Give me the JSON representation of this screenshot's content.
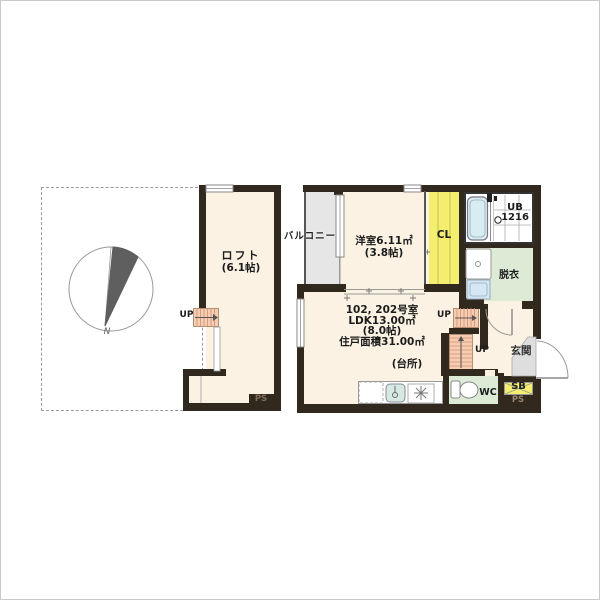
{
  "unit_info": {
    "line1": "102, 202号室",
    "line2": "LDK13.00㎡",
    "line3": "(8.0帖)",
    "line4": "住戸面積31.00㎡"
  },
  "labels": {
    "loft": "ロフト",
    "loft_size": "(6.1帖)",
    "balcony": "バルコニー",
    "western_room": "洋室6.11㎡",
    "western_room_size": "(3.8帖)",
    "closet": "CL",
    "unit_bath": "UB",
    "unit_bath_model": "1216",
    "dressing": "脱衣",
    "entrance": "玄関",
    "wc": "WC",
    "shoe_box": "SB",
    "kitchen": "(台所)",
    "ps_left": "PS",
    "ps_right": "PS",
    "up_loft": "UP",
    "up_main_upper": "UP",
    "up_main_lower": "UP",
    "compass_north": "N"
  },
  "colors": {
    "wall": "#31281e",
    "floor": "#fcf2e4",
    "yellow": "#f4ee6e",
    "green": "#dcead6",
    "gray": "#e6e6e6",
    "stair": "#f6ccb2",
    "bath": "#d8edf1",
    "washer": "#d5e7f5",
    "sink": "#d7eae2"
  }
}
